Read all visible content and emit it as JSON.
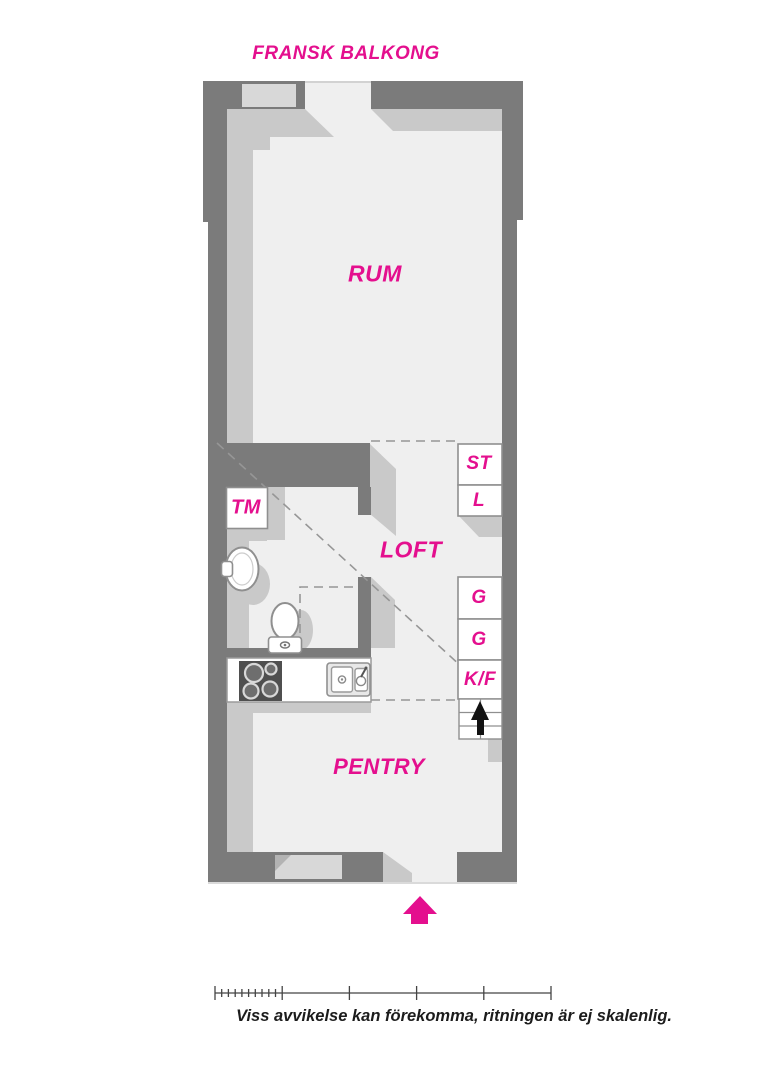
{
  "title": "FRANSK BALKONG",
  "rooms": {
    "rum": "RUM",
    "loft": "LOFT",
    "pentry": "PENTRY"
  },
  "fixtures": {
    "tm": "TM",
    "st": "ST",
    "l": "L",
    "g1": "G",
    "g2": "G",
    "kf": "K/F"
  },
  "icons": {
    "entrance_arrow": "up-arrow",
    "stairs_arrow": "up-arrow"
  },
  "footer": {
    "disclaimer": "Viss avvikelse kan förekomma, ritningen är ej skalenlig."
  },
  "colors": {
    "accent_pink": "#e40f8e",
    "wall_gray": "#7b7b7b",
    "shadow_gray": "#c9c9c9",
    "opening_gray": "#d8d8d8",
    "floor_gray": "#efefef",
    "line_gray": "#8f8f8f",
    "text_black": "#1c1c1c"
  }
}
